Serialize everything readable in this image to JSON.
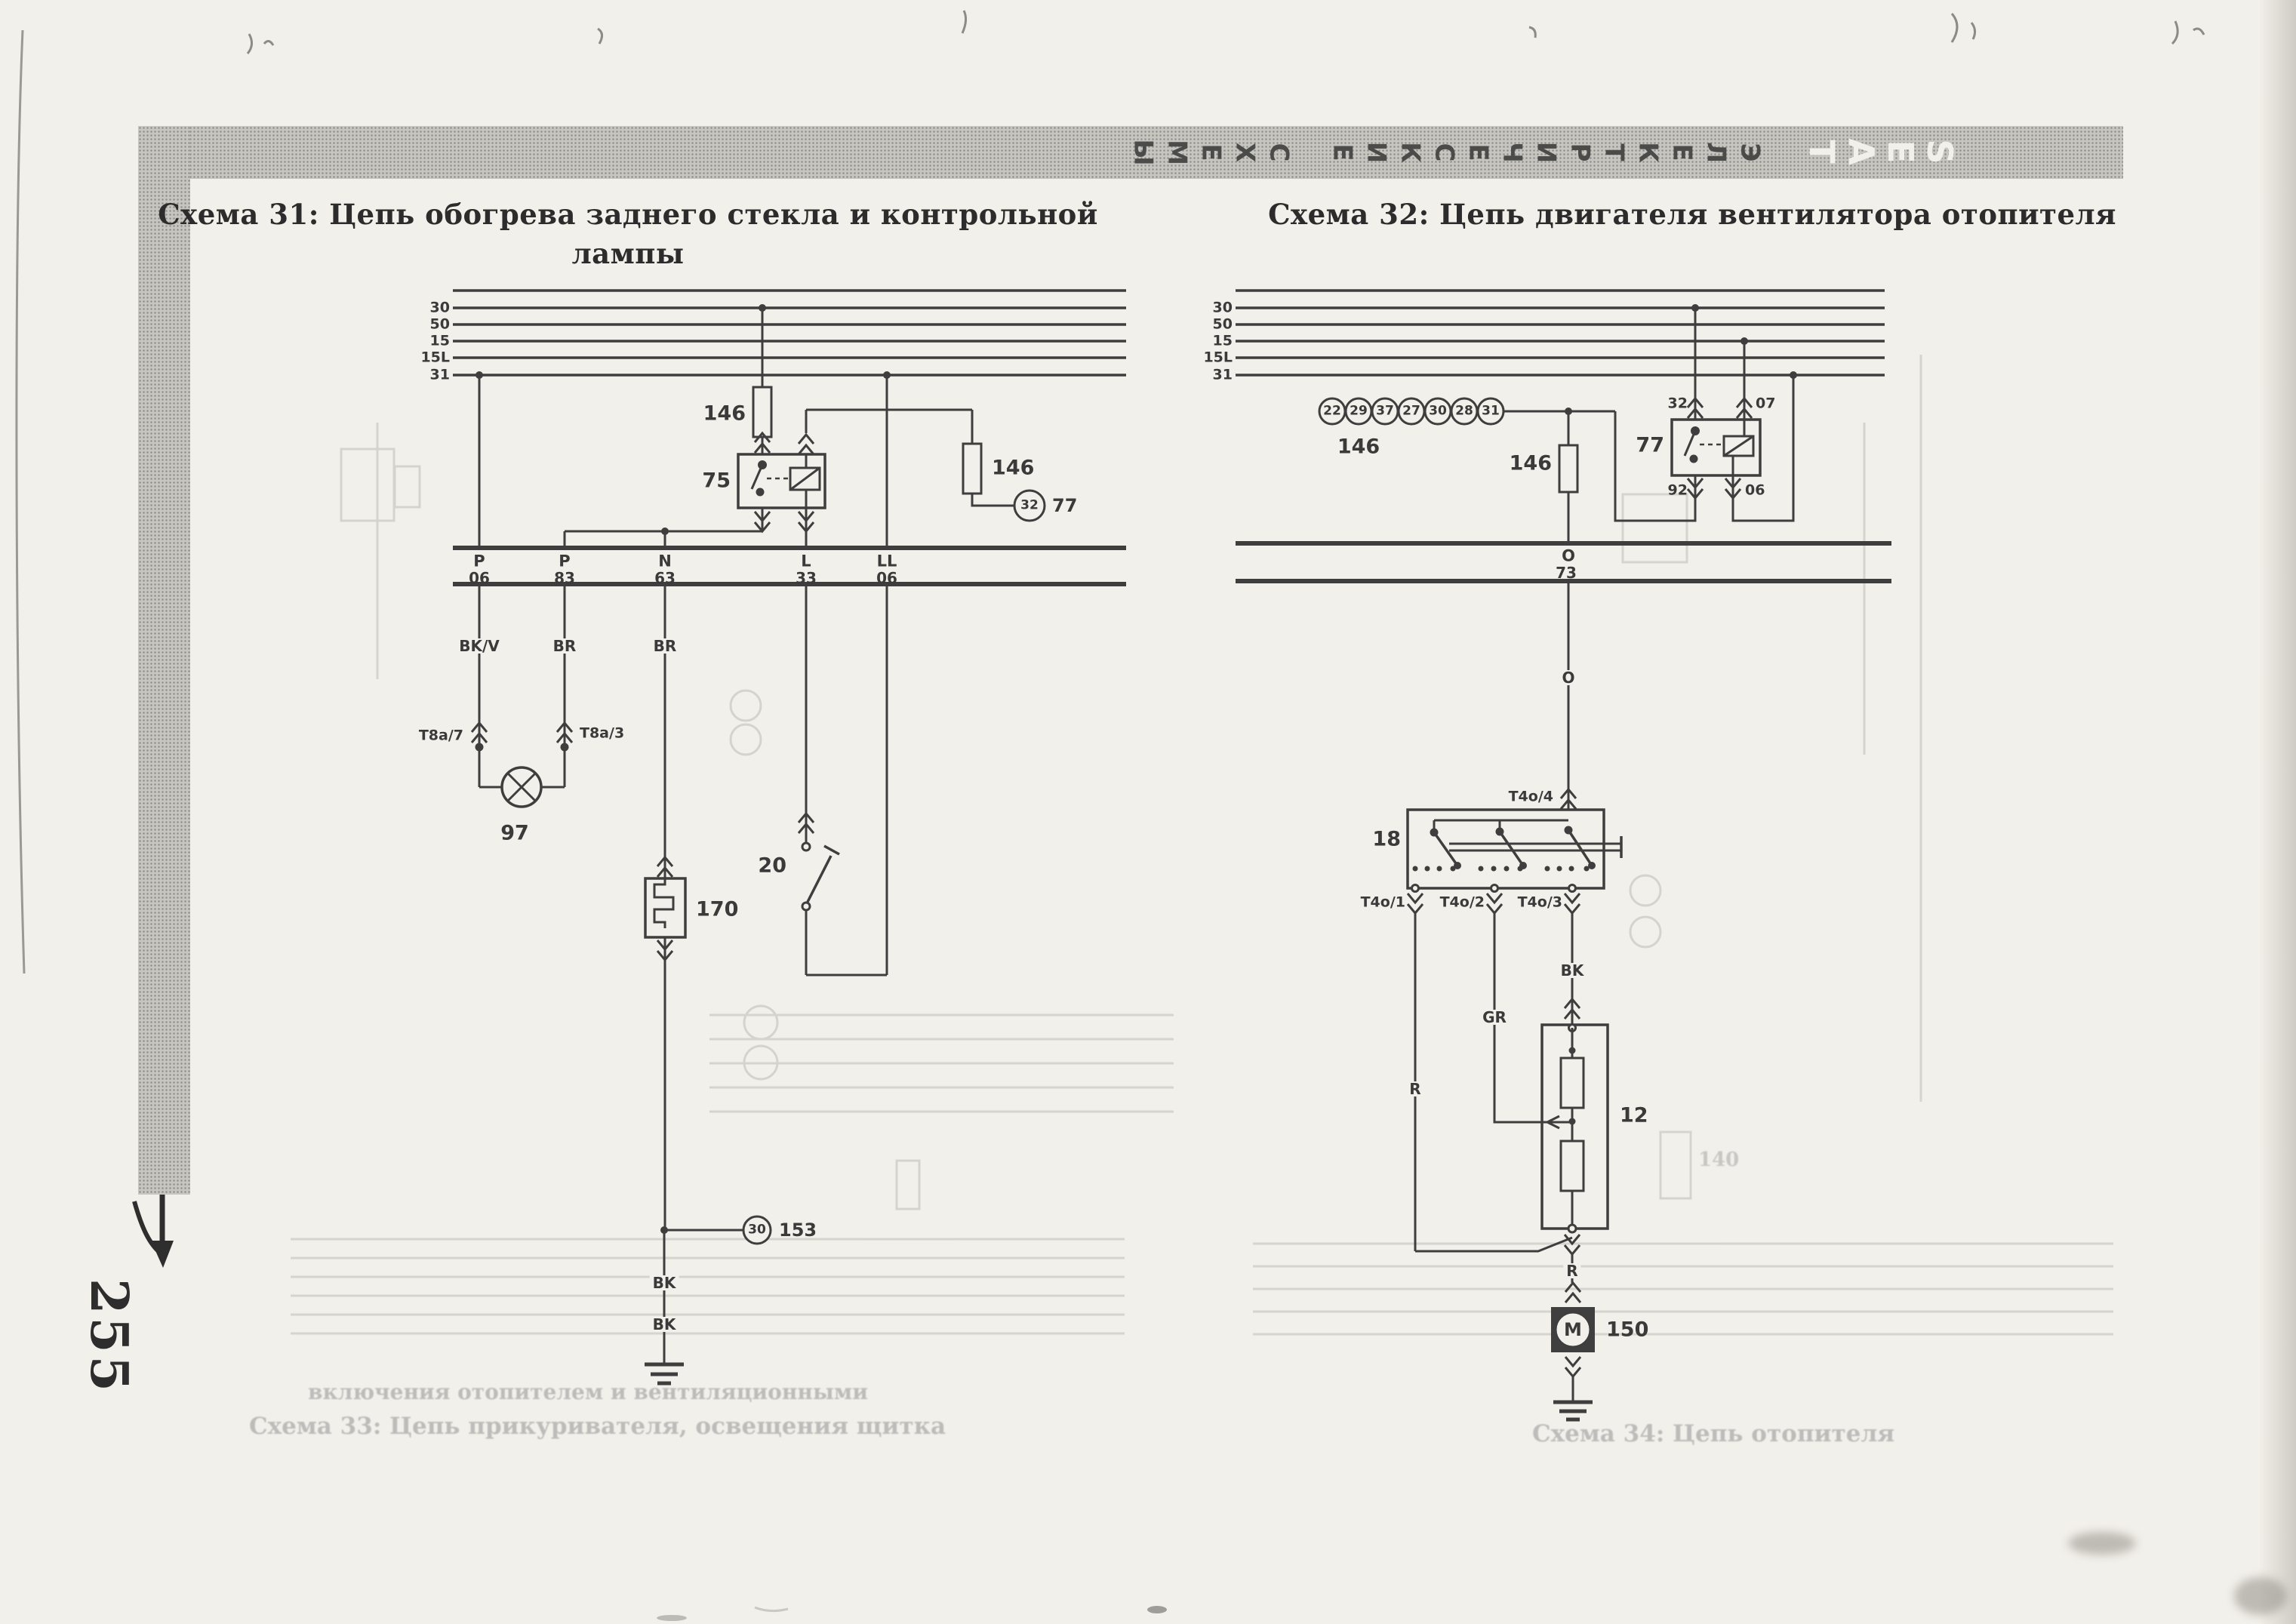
{
  "page_number": "255",
  "banner": {
    "word1": "СХЕМЫ",
    "word2": "ЭЛЕКТРИЧЕСКИЕ",
    "brand": "SEAT"
  },
  "left": {
    "title1": "Схема 31: Цепь обогрева заднего стекла и контрольной",
    "title2": "лампы",
    "bus": [
      "30",
      "50",
      "15",
      "15L",
      "31"
    ],
    "fuse1": "146",
    "relay": "75",
    "fuse2": "146",
    "ring_num": "32",
    "ring_ref": "77",
    "letters": [
      "P",
      "P",
      "N",
      "L",
      "LL"
    ],
    "numbers": [
      "06",
      "83",
      "63",
      "33",
      "06"
    ],
    "wires": [
      "BK/V",
      "BR",
      "BR"
    ],
    "plug1": "T8a/7",
    "plug2": "T8a/3",
    "lamp": "97",
    "element": "170",
    "switch": "20",
    "ring2_num": "30",
    "ring2_ref": "153",
    "bk1": "BK",
    "bk2": "BK"
  },
  "right": {
    "title": "Схема 32: Цепь двигателя вентилятора отопителя",
    "bus": [
      "30",
      "50",
      "15",
      "15L",
      "31"
    ],
    "chain": [
      "22",
      "29",
      "37",
      "27",
      "30",
      "28",
      "31"
    ],
    "chain_ref": "146",
    "fuse": "146",
    "relay": "77",
    "t32": "32",
    "t07": "07",
    "t92": "92",
    "t06": "06",
    "conn_letter": "O",
    "conn_num": "73",
    "wire_o": "O",
    "switch": "18",
    "t4": "T4o/4",
    "t1": "T4o/1",
    "t2": "T4o/2",
    "t3": "T4o/3",
    "wire_bk": "BK",
    "wire_gr": "GR",
    "wire_r": "R",
    "wire_r2": "R",
    "resistor": "12",
    "motor_m": "M",
    "motor_ref": "150"
  },
  "ghost": {
    "left1": "включения отопителем и вентиляционными",
    "left2": "Схема 33: Цепь прикуривателя, освещения щитка",
    "right1": "Схема 34: Цепь отопителя",
    "ref140": "140"
  }
}
